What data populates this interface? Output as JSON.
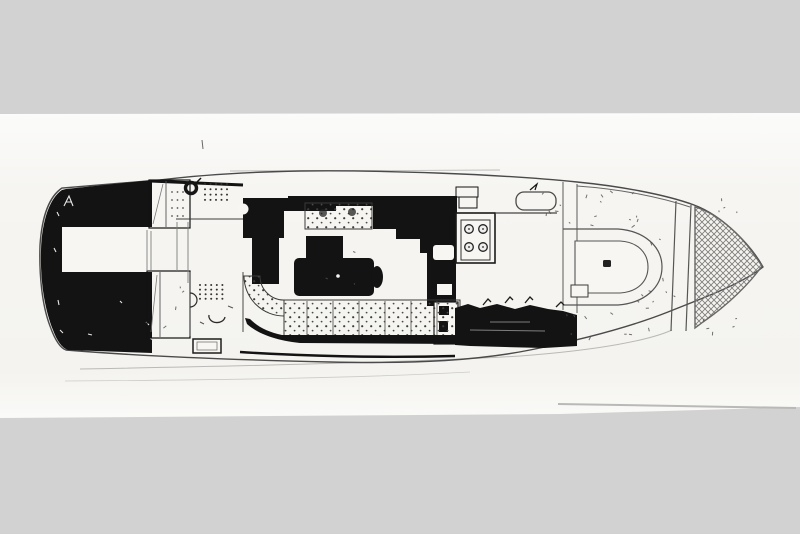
{
  "meta": {
    "type": "scanned-drawing",
    "subject": "motor-yacht deck plan, top view, bow pointing right",
    "visible_text": ""
  },
  "colors": {
    "background": "#d2d2d2",
    "paper": "#f7f6f3",
    "paper_highlight": "#fcfcfb",
    "ink": "#131313",
    "line": "#4a4a4a",
    "faint": "#b9b9b7",
    "hatch": "#7e7e7c"
  }
}
